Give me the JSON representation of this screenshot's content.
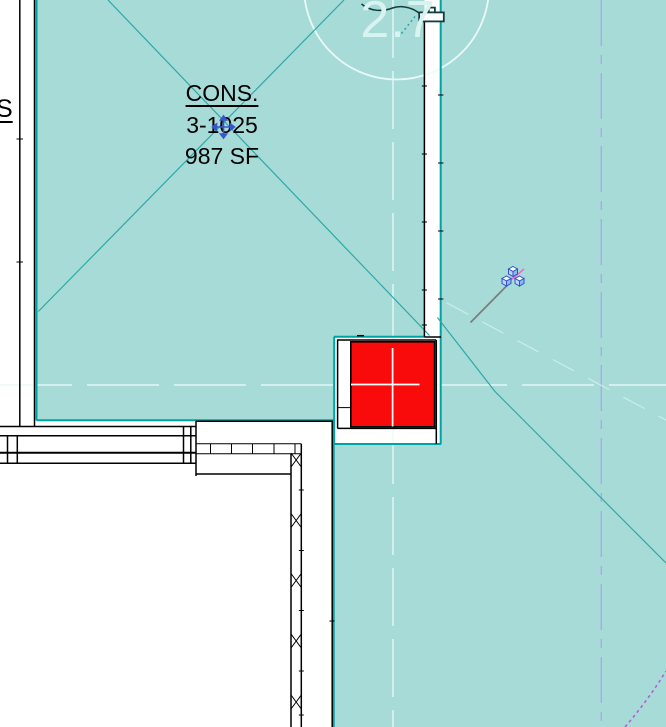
{
  "view": {
    "type": "floor-plan-canvas"
  },
  "grid_bubble": {
    "label": "2.7"
  },
  "room_tag": {
    "name": "CONS.",
    "number": "3-1025",
    "area": "987 SF"
  },
  "adjacent_room_tag": {
    "name_fragment": "S"
  },
  "colors": {
    "room_fill": "#a7dbd8",
    "room_boundary": "#00a2a2",
    "room_diagonal": "#2fa8a5",
    "column_fill": "#f90b0b",
    "wall_line": "#000000",
    "reference_white": "#e9fbfa",
    "grid_dashed": "#a9a9f2",
    "underlay_faint": "#c9ece9",
    "annotation_purple": "#b35fd6",
    "cursor_gray": "#7d7d7d",
    "cursor_pink": "#ff5fc8",
    "cursor_cube_blue": "#2e55c6",
    "move_icon_blue": "#3a55cc",
    "tag_text": "#000000",
    "grid_text": "#d9f3f1",
    "grid_circle": "#ecfbf9",
    "element_dark": "#123d3f"
  }
}
